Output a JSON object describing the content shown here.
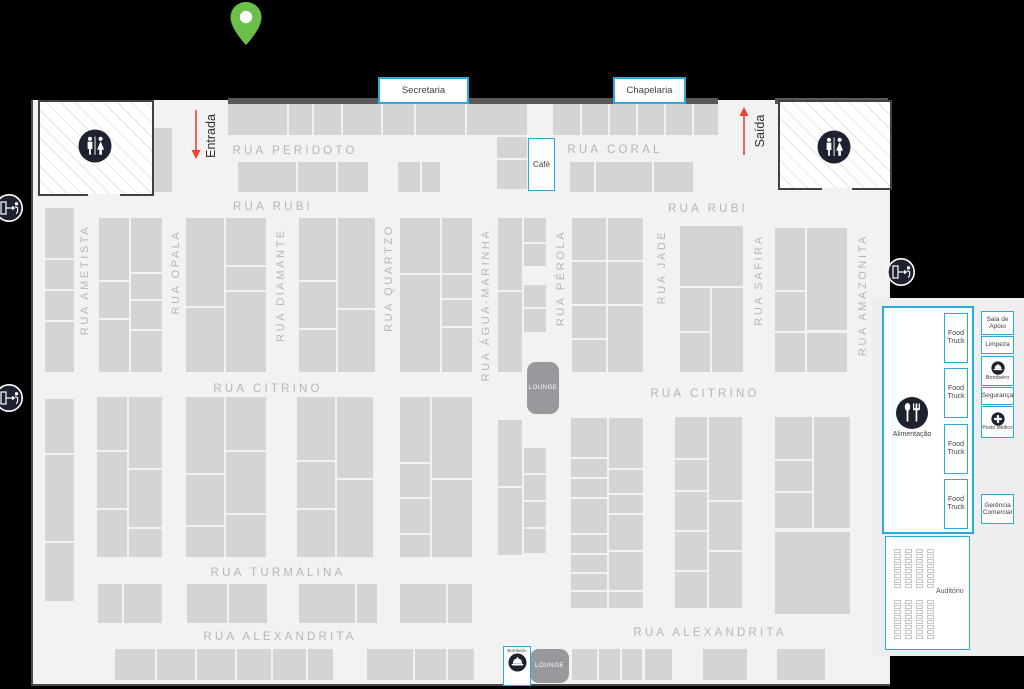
{
  "colors": {
    "background": "#000000",
    "floor": "#f2f2f3",
    "booth": "#d2d4d6",
    "wall": "#58595b",
    "street_label": "#b3b6b8",
    "accent_blue": "#29abe2",
    "lounge_gray": "#97999c",
    "arrow_red": "#ee4036",
    "pin_green": "#6cbf4b",
    "icon_dark": "#1e2230"
  },
  "top_boxes": {
    "secretaria": "Secretaria",
    "chapelaria": "Chapelaria"
  },
  "entrance_label": "Entrada",
  "exit_label": "Saída",
  "cafe_label": "Café",
  "lounge_label": "LOUNGE",
  "bombeiro_station_label": "Bombeiro",
  "right_panel": {
    "alimentacao_label": "Alimentação",
    "food_truck_label": "Food Truck",
    "food_truck_tops": [
      313,
      368,
      424,
      479
    ],
    "services": [
      {
        "label": "Sala de Apoio"
      },
      {
        "label": "Limpeza"
      },
      {
        "label": "Bombeiro",
        "icon": "firefighter-helmet-icon"
      },
      {
        "label": "Segurança"
      },
      {
        "label": "Posto Médico",
        "icon": "medical-cross-icon"
      },
      {
        "label": "Gerência Comercial"
      }
    ],
    "auditorio_label": "Auditório",
    "auditorium_seats": {
      "groups": 2,
      "cols": 4,
      "rows": 8,
      "group_tops": [
        549,
        600
      ]
    }
  },
  "map": {
    "streets_horizontal": [
      {
        "label": "RUA PERIDOTO",
        "x": 295,
        "y": 151
      },
      {
        "label": "RUA CORAL",
        "x": 615,
        "y": 150
      },
      {
        "label": "RUA RUBI",
        "x": 273,
        "y": 207
      },
      {
        "label": "RUA RUBI",
        "x": 708,
        "y": 209
      },
      {
        "label": "RUA CITRINO",
        "x": 268,
        "y": 389
      },
      {
        "label": "RUA CITRINO",
        "x": 705,
        "y": 394
      },
      {
        "label": "RUA TURMALINA",
        "x": 278,
        "y": 573
      },
      {
        "label": "RUA ALEXANDRITA",
        "x": 280,
        "y": 637
      },
      {
        "label": "RUA ALEXANDRITA",
        "x": 710,
        "y": 633
      }
    ],
    "streets_vertical": [
      {
        "label": "RUA AMETISTA",
        "x": 85,
        "y": 280
      },
      {
        "label": "RUA OPALA",
        "x": 176,
        "y": 272
      },
      {
        "label": "RUA DIAMANTE",
        "x": 281,
        "y": 285
      },
      {
        "label": "RUA QUARTZO",
        "x": 389,
        "y": 278
      },
      {
        "label": "RUA ÁGUA-MARINHA",
        "x": 486,
        "y": 305
      },
      {
        "label": "RUA PÉROLA",
        "x": 561,
        "y": 278
      },
      {
        "label": "RUA JADE",
        "x": 662,
        "y": 267
      },
      {
        "label": "RUA SAFIRA",
        "x": 759,
        "y": 280
      },
      {
        "label": "RUA AMAZONITA",
        "x": 863,
        "y": 295
      }
    ],
    "booths": [
      [
        228,
        104,
        59,
        31
      ],
      [
        289,
        104,
        23,
        31
      ],
      [
        314,
        104,
        27,
        31
      ],
      [
        343,
        104,
        38,
        31
      ],
      [
        383,
        104,
        31,
        31
      ],
      [
        416,
        104,
        49,
        31
      ],
      [
        467,
        104,
        60,
        31
      ],
      [
        497,
        137,
        30,
        21
      ],
      [
        497,
        160,
        30,
        29
      ],
      [
        553,
        104,
        27,
        31
      ],
      [
        582,
        104,
        26,
        31
      ],
      [
        610,
        104,
        26,
        31
      ],
      [
        638,
        104,
        26,
        31
      ],
      [
        666,
        104,
        26,
        31
      ],
      [
        694,
        104,
        24,
        31
      ],
      [
        238,
        162,
        58,
        30
      ],
      [
        298,
        162,
        38,
        30
      ],
      [
        338,
        162,
        30,
        30
      ],
      [
        398,
        162,
        22,
        30
      ],
      [
        422,
        162,
        18,
        30
      ],
      [
        570,
        162,
        24,
        30
      ],
      [
        596,
        162,
        56,
        30
      ],
      [
        654,
        162,
        39,
        30
      ],
      [
        152,
        128,
        20,
        64
      ],
      [
        45,
        208,
        29,
        50
      ],
      [
        45,
        260,
        29,
        29
      ],
      [
        45,
        291,
        29,
        29
      ],
      [
        45,
        322,
        29,
        50
      ],
      [
        99,
        218,
        30,
        62
      ],
      [
        99,
        282,
        30,
        36
      ],
      [
        99,
        320,
        30,
        52
      ],
      [
        131,
        218,
        31,
        54
      ],
      [
        131,
        274,
        31,
        25
      ],
      [
        131,
        301,
        31,
        28
      ],
      [
        131,
        331,
        31,
        41
      ],
      [
        186,
        218,
        38,
        88
      ],
      [
        186,
        308,
        38,
        64
      ],
      [
        226,
        218,
        40,
        47
      ],
      [
        226,
        267,
        40,
        23
      ],
      [
        226,
        292,
        40,
        80
      ],
      [
        299,
        218,
        37,
        62
      ],
      [
        299,
        282,
        37,
        46
      ],
      [
        299,
        330,
        37,
        42
      ],
      [
        338,
        218,
        37,
        90
      ],
      [
        338,
        310,
        37,
        62
      ],
      [
        400,
        218,
        40,
        55
      ],
      [
        400,
        275,
        40,
        97
      ],
      [
        442,
        218,
        30,
        55
      ],
      [
        442,
        275,
        30,
        23
      ],
      [
        442,
        300,
        30,
        26
      ],
      [
        442,
        328,
        30,
        44
      ],
      [
        498,
        218,
        24,
        72
      ],
      [
        498,
        292,
        24,
        80
      ],
      [
        524,
        218,
        22,
        24
      ],
      [
        524,
        244,
        22,
        22
      ],
      [
        524,
        285,
        22,
        22
      ],
      [
        524,
        309,
        22,
        23
      ],
      [
        572,
        218,
        34,
        42
      ],
      [
        572,
        262,
        34,
        42
      ],
      [
        572,
        306,
        34,
        32
      ],
      [
        572,
        340,
        34,
        32
      ],
      [
        608,
        218,
        35,
        42
      ],
      [
        608,
        262,
        35,
        42
      ],
      [
        608,
        306,
        35,
        66
      ],
      [
        680,
        226,
        63,
        60
      ],
      [
        680,
        288,
        30,
        43
      ],
      [
        680,
        333,
        30,
        39
      ],
      [
        712,
        288,
        31,
        84
      ],
      [
        775,
        228,
        30,
        62
      ],
      [
        775,
        292,
        30,
        39
      ],
      [
        775,
        333,
        30,
        39
      ],
      [
        807,
        228,
        40,
        102
      ],
      [
        807,
        333,
        40,
        39
      ],
      [
        45,
        399,
        29,
        54
      ],
      [
        45,
        455,
        29,
        86
      ],
      [
        45,
        543,
        29,
        58
      ],
      [
        97,
        397,
        30,
        53
      ],
      [
        97,
        452,
        30,
        56
      ],
      [
        97,
        510,
        30,
        47
      ],
      [
        129,
        397,
        33,
        71
      ],
      [
        129,
        470,
        33,
        57
      ],
      [
        129,
        529,
        33,
        28
      ],
      [
        186,
        397,
        38,
        76
      ],
      [
        186,
        475,
        38,
        50
      ],
      [
        186,
        527,
        38,
        30
      ],
      [
        226,
        397,
        40,
        53
      ],
      [
        226,
        452,
        40,
        61
      ],
      [
        226,
        515,
        40,
        42
      ],
      [
        297,
        397,
        38,
        63
      ],
      [
        297,
        462,
        38,
        46
      ],
      [
        297,
        510,
        38,
        47
      ],
      [
        337,
        397,
        36,
        81
      ],
      [
        337,
        480,
        36,
        77
      ],
      [
        400,
        397,
        30,
        65
      ],
      [
        400,
        464,
        30,
        33
      ],
      [
        400,
        499,
        30,
        34
      ],
      [
        400,
        535,
        30,
        22
      ],
      [
        432,
        397,
        40,
        81
      ],
      [
        432,
        480,
        40,
        77
      ],
      [
        498,
        420,
        24,
        66
      ],
      [
        498,
        488,
        24,
        67
      ],
      [
        524,
        448,
        22,
        25
      ],
      [
        524,
        475,
        22,
        25
      ],
      [
        524,
        502,
        22,
        25
      ],
      [
        524,
        529,
        22,
        24
      ],
      [
        571,
        418,
        36,
        39
      ],
      [
        571,
        459,
        36,
        18
      ],
      [
        571,
        479,
        36,
        18
      ],
      [
        571,
        499,
        36,
        34
      ],
      [
        571,
        535,
        36,
        18
      ],
      [
        571,
        555,
        36,
        17
      ],
      [
        571,
        574,
        36,
        16
      ],
      [
        571,
        592,
        36,
        16
      ],
      [
        609,
        418,
        34,
        50
      ],
      [
        609,
        470,
        34,
        23
      ],
      [
        609,
        495,
        34,
        18
      ],
      [
        609,
        515,
        34,
        35
      ],
      [
        609,
        552,
        34,
        38
      ],
      [
        609,
        592,
        34,
        16
      ],
      [
        675,
        417,
        32,
        41
      ],
      [
        675,
        460,
        32,
        30
      ],
      [
        675,
        492,
        32,
        38
      ],
      [
        675,
        532,
        32,
        38
      ],
      [
        675,
        572,
        32,
        36
      ],
      [
        709,
        417,
        33,
        83
      ],
      [
        709,
        502,
        33,
        48
      ],
      [
        709,
        552,
        33,
        56
      ],
      [
        775,
        417,
        37,
        42
      ],
      [
        775,
        461,
        37,
        30
      ],
      [
        775,
        493,
        37,
        35
      ],
      [
        814,
        417,
        36,
        111
      ],
      [
        775,
        532,
        75,
        82
      ],
      [
        98,
        584,
        24,
        39
      ],
      [
        124,
        584,
        38,
        39
      ],
      [
        187,
        584,
        40,
        39
      ],
      [
        229,
        584,
        38,
        39
      ],
      [
        299,
        584,
        56,
        39
      ],
      [
        357,
        584,
        20,
        39
      ],
      [
        400,
        584,
        46,
        39
      ],
      [
        448,
        584,
        24,
        39
      ],
      [
        115,
        649,
        40,
        31
      ],
      [
        157,
        649,
        38,
        31
      ],
      [
        197,
        649,
        38,
        31
      ],
      [
        237,
        649,
        34,
        31
      ],
      [
        273,
        649,
        33,
        31
      ],
      [
        308,
        649,
        25,
        31
      ],
      [
        367,
        649,
        46,
        31
      ],
      [
        415,
        649,
        31,
        31
      ],
      [
        448,
        649,
        26,
        31
      ],
      [
        572,
        649,
        25,
        31
      ],
      [
        599,
        649,
        21,
        31
      ],
      [
        622,
        649,
        20,
        31
      ],
      [
        645,
        649,
        27,
        31
      ],
      [
        703,
        649,
        44,
        31
      ],
      [
        777,
        649,
        48,
        31
      ]
    ]
  }
}
